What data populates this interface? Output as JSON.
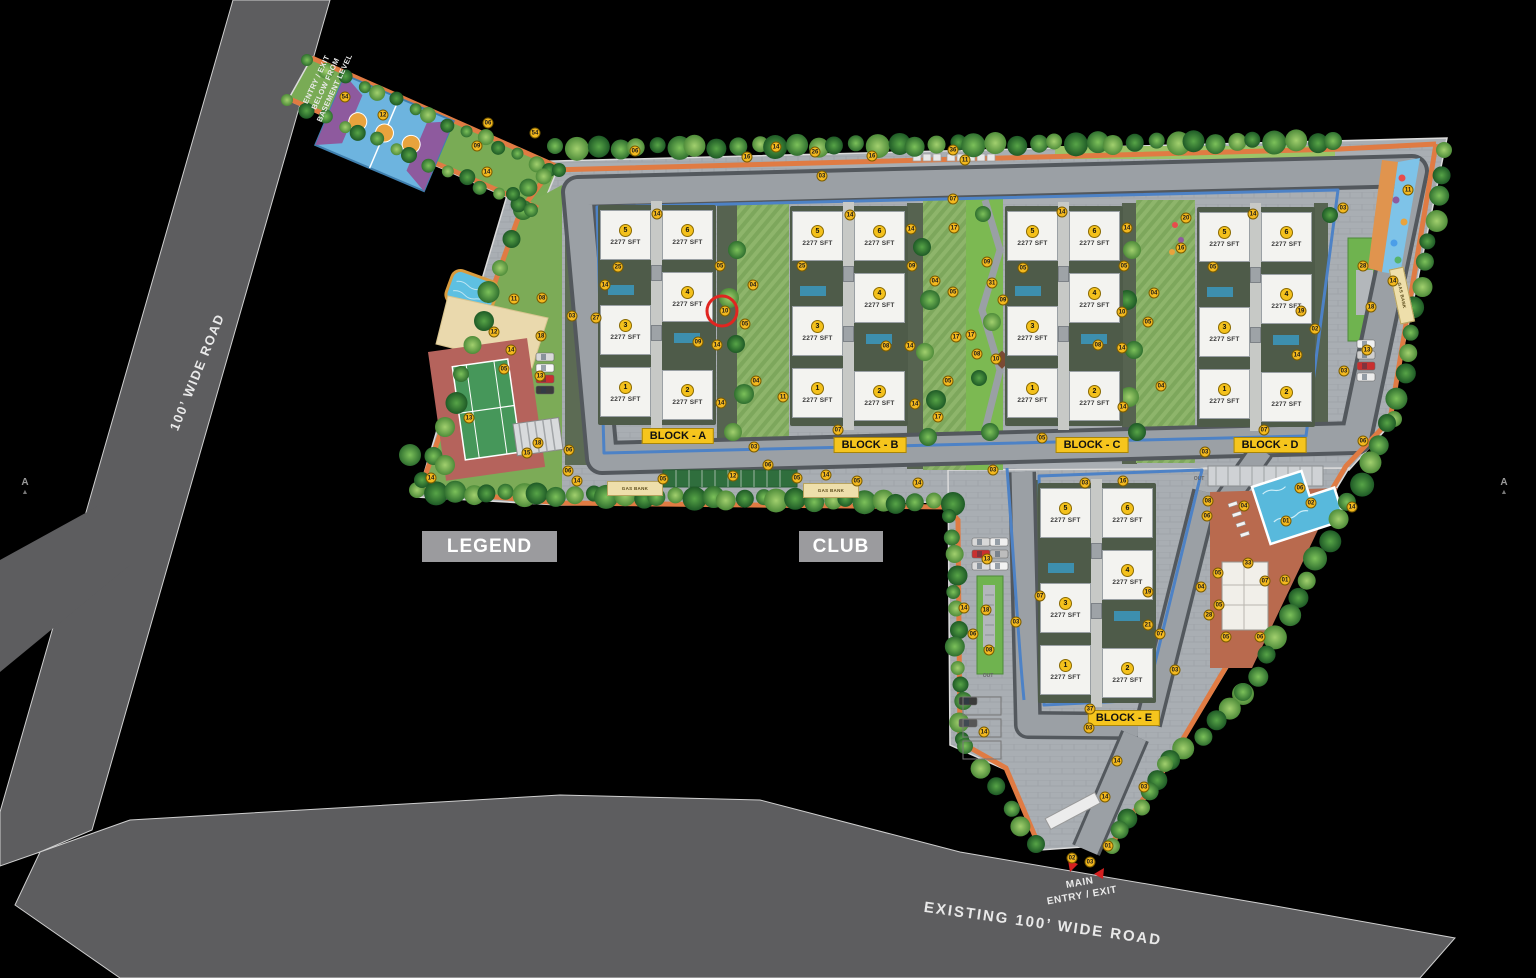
{
  "site": {
    "roads": {
      "left": "100’ WIDE ROAD",
      "bottom": "EXISTING 100’ WIDE ROAD"
    },
    "entries": {
      "basement_l1": "ENTRY / EXIT",
      "basement_l2": "BELOW FROM",
      "basement_l3": "BASEMENT LEVEL",
      "main_l1": "MAIN",
      "main_l2": "ENTRY / EXIT"
    },
    "legend": "LEGEND",
    "club": "CLUB",
    "gas_bank": "GAS BANK",
    "out": "OUT",
    "section_marker": "A",
    "section_arrow": "▲",
    "unit_area": "2277 SFT",
    "blocks": [
      {
        "id": "A",
        "label": "BLOCK - A",
        "x": 598,
        "y": 205,
        "lx": 678,
        "ly": 436,
        "units": [
          {
            "no": "5",
            "area": "2277 SFT"
          },
          {
            "no": "6",
            "area": "2277 SFT"
          },
          {
            "no": "3",
            "area": "2277 SFT"
          },
          {
            "no": "4",
            "area": "2277 SFT"
          },
          {
            "no": "1",
            "area": "2277 SFT"
          },
          {
            "no": "2",
            "area": "2277 SFT"
          }
        ]
      },
      {
        "id": "B",
        "label": "BLOCK - B",
        "x": 790,
        "y": 206,
        "lx": 870,
        "ly": 445,
        "units": [
          {
            "no": "5",
            "area": "2277 SFT"
          },
          {
            "no": "6",
            "area": "2277 SFT"
          },
          {
            "no": "3",
            "area": "2277 SFT"
          },
          {
            "no": "4",
            "area": "2277 SFT"
          },
          {
            "no": "1",
            "area": "2277 SFT"
          },
          {
            "no": "2",
            "area": "2277 SFT"
          }
        ]
      },
      {
        "id": "C",
        "label": "BLOCK - C",
        "x": 1005,
        "y": 206,
        "lx": 1092,
        "ly": 445,
        "units": [
          {
            "no": "5",
            "area": "2277 SFT"
          },
          {
            "no": "6",
            "area": "2277 SFT"
          },
          {
            "no": "3",
            "area": "2277 SFT"
          },
          {
            "no": "4",
            "area": "2277 SFT"
          },
          {
            "no": "1",
            "area": "2277 SFT"
          },
          {
            "no": "2",
            "area": "2277 SFT"
          }
        ]
      },
      {
        "id": "D",
        "label": "BLOCK - D",
        "x": 1197,
        "y": 207,
        "lx": 1270,
        "ly": 445,
        "units": [
          {
            "no": "5",
            "area": "2277 SFT"
          },
          {
            "no": "6",
            "area": "2277 SFT"
          },
          {
            "no": "3",
            "area": "2277 SFT"
          },
          {
            "no": "4",
            "area": "2277 SFT"
          },
          {
            "no": "1",
            "area": "2277 SFT"
          },
          {
            "no": "2",
            "area": "2277 SFT"
          }
        ]
      },
      {
        "id": "E",
        "label": "BLOCK - E",
        "x": 1038,
        "y": 483,
        "lx": 1124,
        "ly": 718,
        "units": [
          {
            "no": "5",
            "area": "2277 SFT"
          },
          {
            "no": "6",
            "area": "2277 SFT"
          },
          {
            "no": "3",
            "area": "2277 SFT"
          },
          {
            "no": "4",
            "area": "2277 SFT"
          },
          {
            "no": "1",
            "area": "2277 SFT"
          },
          {
            "no": "2",
            "area": "2277 SFT"
          }
        ]
      }
    ],
    "highlight": {
      "n": "10",
      "x": 722,
      "y": 311
    },
    "markers": [
      {
        "n": "54",
        "x": 345,
        "y": 97
      },
      {
        "n": "12",
        "x": 383,
        "y": 115
      },
      {
        "n": "06",
        "x": 488,
        "y": 123
      },
      {
        "n": "54",
        "x": 535,
        "y": 133
      },
      {
        "n": "09",
        "x": 477,
        "y": 146
      },
      {
        "n": "14",
        "x": 487,
        "y": 172
      },
      {
        "n": "06",
        "x": 635,
        "y": 151
      },
      {
        "n": "16",
        "x": 747,
        "y": 157
      },
      {
        "n": "14",
        "x": 776,
        "y": 147
      },
      {
        "n": "26",
        "x": 815,
        "y": 152
      },
      {
        "n": "16",
        "x": 872,
        "y": 156
      },
      {
        "n": "36",
        "x": 953,
        "y": 150
      },
      {
        "n": "11",
        "x": 965,
        "y": 160
      },
      {
        "n": "03",
        "x": 822,
        "y": 176
      },
      {
        "n": "07",
        "x": 953,
        "y": 199
      },
      {
        "n": "14",
        "x": 657,
        "y": 214
      },
      {
        "n": "25",
        "x": 618,
        "y": 267
      },
      {
        "n": "14",
        "x": 605,
        "y": 285
      },
      {
        "n": "27",
        "x": 596,
        "y": 318
      },
      {
        "n": "05",
        "x": 720,
        "y": 266
      },
      {
        "n": "04",
        "x": 753,
        "y": 285
      },
      {
        "n": "05",
        "x": 745,
        "y": 324
      },
      {
        "n": "10",
        "x": 725,
        "y": 311
      },
      {
        "n": "09",
        "x": 698,
        "y": 342
      },
      {
        "n": "14",
        "x": 717,
        "y": 345
      },
      {
        "n": "04",
        "x": 756,
        "y": 381
      },
      {
        "n": "14",
        "x": 721,
        "y": 403
      },
      {
        "n": "03",
        "x": 754,
        "y": 447
      },
      {
        "n": "14",
        "x": 850,
        "y": 215
      },
      {
        "n": "14",
        "x": 911,
        "y": 229
      },
      {
        "n": "25",
        "x": 802,
        "y": 266
      },
      {
        "n": "09",
        "x": 912,
        "y": 266
      },
      {
        "n": "04",
        "x": 935,
        "y": 281
      },
      {
        "n": "05",
        "x": 953,
        "y": 292
      },
      {
        "n": "17",
        "x": 954,
        "y": 228
      },
      {
        "n": "08",
        "x": 886,
        "y": 346
      },
      {
        "n": "14",
        "x": 910,
        "y": 346
      },
      {
        "n": "17",
        "x": 956,
        "y": 337
      },
      {
        "n": "05",
        "x": 948,
        "y": 381
      },
      {
        "n": "14",
        "x": 915,
        "y": 404
      },
      {
        "n": "17",
        "x": 938,
        "y": 417
      },
      {
        "n": "11",
        "x": 783,
        "y": 397
      },
      {
        "n": "07",
        "x": 838,
        "y": 430
      },
      {
        "n": "09",
        "x": 987,
        "y": 262
      },
      {
        "n": "31",
        "x": 992,
        "y": 283
      },
      {
        "n": "09",
        "x": 1003,
        "y": 300
      },
      {
        "n": "17",
        "x": 971,
        "y": 335
      },
      {
        "n": "08",
        "x": 977,
        "y": 354
      },
      {
        "n": "10",
        "x": 996,
        "y": 359
      },
      {
        "n": "14",
        "x": 1062,
        "y": 212
      },
      {
        "n": "14",
        "x": 1127,
        "y": 228
      },
      {
        "n": "20",
        "x": 1186,
        "y": 218
      },
      {
        "n": "16",
        "x": 1181,
        "y": 248
      },
      {
        "n": "05",
        "x": 1023,
        "y": 268
      },
      {
        "n": "05",
        "x": 1124,
        "y": 266
      },
      {
        "n": "04",
        "x": 1154,
        "y": 293
      },
      {
        "n": "10",
        "x": 1122,
        "y": 312
      },
      {
        "n": "05",
        "x": 1148,
        "y": 322
      },
      {
        "n": "08",
        "x": 1098,
        "y": 345
      },
      {
        "n": "14",
        "x": 1122,
        "y": 348
      },
      {
        "n": "04",
        "x": 1161,
        "y": 386
      },
      {
        "n": "14",
        "x": 1123,
        "y": 407
      },
      {
        "n": "05",
        "x": 1042,
        "y": 438
      },
      {
        "n": "03",
        "x": 1343,
        "y": 208
      },
      {
        "n": "05",
        "x": 1213,
        "y": 267
      },
      {
        "n": "14",
        "x": 1253,
        "y": 214
      },
      {
        "n": "19",
        "x": 1301,
        "y": 311
      },
      {
        "n": "02",
        "x": 1315,
        "y": 329
      },
      {
        "n": "14",
        "x": 1297,
        "y": 355
      },
      {
        "n": "28",
        "x": 1363,
        "y": 266
      },
      {
        "n": "18",
        "x": 1371,
        "y": 307
      },
      {
        "n": "13",
        "x": 1367,
        "y": 350
      },
      {
        "n": "03",
        "x": 1344,
        "y": 371
      },
      {
        "n": "06",
        "x": 1363,
        "y": 441
      },
      {
        "n": "07",
        "x": 1264,
        "y": 430
      },
      {
        "n": "03",
        "x": 1205,
        "y": 452
      },
      {
        "n": "11",
        "x": 1408,
        "y": 190
      },
      {
        "n": "14",
        "x": 1393,
        "y": 281
      },
      {
        "n": "06",
        "x": 1300,
        "y": 488
      },
      {
        "n": "02",
        "x": 1311,
        "y": 503
      },
      {
        "n": "01",
        "x": 1286,
        "y": 521
      },
      {
        "n": "14",
        "x": 1352,
        "y": 507
      },
      {
        "n": "04",
        "x": 1244,
        "y": 506
      },
      {
        "n": "08",
        "x": 1208,
        "y": 501
      },
      {
        "n": "06",
        "x": 1207,
        "y": 516
      },
      {
        "n": "33",
        "x": 1248,
        "y": 563
      },
      {
        "n": "05",
        "x": 1218,
        "y": 573
      },
      {
        "n": "04",
        "x": 1201,
        "y": 587
      },
      {
        "n": "07",
        "x": 1265,
        "y": 581
      },
      {
        "n": "01",
        "x": 1285,
        "y": 580
      },
      {
        "n": "05",
        "x": 1219,
        "y": 605
      },
      {
        "n": "28",
        "x": 1209,
        "y": 615
      },
      {
        "n": "05",
        "x": 1226,
        "y": 637
      },
      {
        "n": "06",
        "x": 1260,
        "y": 637
      },
      {
        "n": "03",
        "x": 1085,
        "y": 483
      },
      {
        "n": "16",
        "x": 1123,
        "y": 481
      },
      {
        "n": "07",
        "x": 1040,
        "y": 596
      },
      {
        "n": "19",
        "x": 1148,
        "y": 592
      },
      {
        "n": "21",
        "x": 1148,
        "y": 625
      },
      {
        "n": "07",
        "x": 1160,
        "y": 634
      },
      {
        "n": "03",
        "x": 1175,
        "y": 670
      },
      {
        "n": "37",
        "x": 1090,
        "y": 709
      },
      {
        "n": "03",
        "x": 1089,
        "y": 728
      },
      {
        "n": "13",
        "x": 987,
        "y": 559
      },
      {
        "n": "14",
        "x": 964,
        "y": 608
      },
      {
        "n": "18",
        "x": 986,
        "y": 610
      },
      {
        "n": "03",
        "x": 1016,
        "y": 622
      },
      {
        "n": "06",
        "x": 973,
        "y": 634
      },
      {
        "n": "08",
        "x": 989,
        "y": 650
      },
      {
        "n": "14",
        "x": 984,
        "y": 732
      },
      {
        "n": "06",
        "x": 568,
        "y": 471
      },
      {
        "n": "14",
        "x": 577,
        "y": 481
      },
      {
        "n": "06",
        "x": 768,
        "y": 465
      },
      {
        "n": "05",
        "x": 663,
        "y": 479
      },
      {
        "n": "12",
        "x": 733,
        "y": 476
      },
      {
        "n": "05",
        "x": 797,
        "y": 478
      },
      {
        "n": "14",
        "x": 826,
        "y": 475
      },
      {
        "n": "05",
        "x": 857,
        "y": 481
      },
      {
        "n": "14",
        "x": 918,
        "y": 483
      },
      {
        "n": "03",
        "x": 993,
        "y": 470
      },
      {
        "n": "11",
        "x": 514,
        "y": 299
      },
      {
        "n": "08",
        "x": 542,
        "y": 298
      },
      {
        "n": "03",
        "x": 572,
        "y": 316
      },
      {
        "n": "12",
        "x": 494,
        "y": 332
      },
      {
        "n": "18",
        "x": 541,
        "y": 336
      },
      {
        "n": "14",
        "x": 511,
        "y": 350
      },
      {
        "n": "05",
        "x": 504,
        "y": 369
      },
      {
        "n": "13",
        "x": 540,
        "y": 376
      },
      {
        "n": "13",
        "x": 469,
        "y": 418
      },
      {
        "n": "18",
        "x": 538,
        "y": 443
      },
      {
        "n": "15",
        "x": 527,
        "y": 453
      },
      {
        "n": "06",
        "x": 569,
        "y": 450
      },
      {
        "n": "14",
        "x": 431,
        "y": 478
      },
      {
        "n": "01",
        "x": 1108,
        "y": 846
      },
      {
        "n": "02",
        "x": 1072,
        "y": 858
      },
      {
        "n": "03",
        "x": 1090,
        "y": 862
      },
      {
        "n": "03",
        "x": 1144,
        "y": 787
      },
      {
        "n": "14",
        "x": 1117,
        "y": 761
      },
      {
        "n": "14",
        "x": 1105,
        "y": 797
      }
    ]
  },
  "colors": {
    "road": "#5d5d5f",
    "paving": "#a9aeb3",
    "ring_road": "#9ba0a5",
    "road_edge": "#53585d",
    "basement_line": "#4d82c6",
    "perimeter_path": "#e07b43",
    "lawn": "#7cb952",
    "block_label_bg": "#f6c51d",
    "marker_bg": "#f3b81e",
    "highlight_ring": "#e02520",
    "pool": "#58b9dc",
    "tennis_surround": "#b5635c",
    "tennis_court": "#46975a",
    "basketball": "#6db4df",
    "sand": "#ead9ad",
    "gray_box": "#9b9b9e"
  }
}
